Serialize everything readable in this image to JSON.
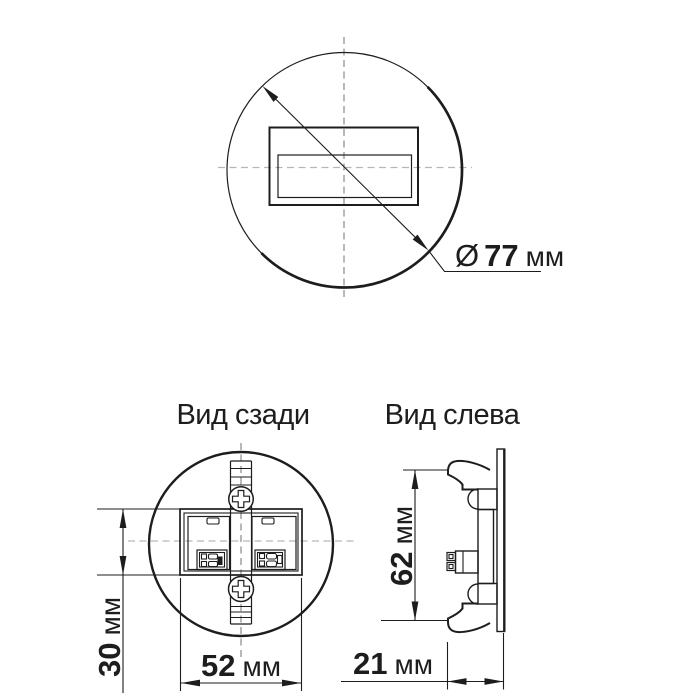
{
  "colors": {
    "line": "#1d1d1d",
    "centerline_dark": "#8a8a8a",
    "centerline_light": "#b6b6b6",
    "text": "#1d1d1d",
    "background": "#ffffff"
  },
  "front_view": {
    "dim_diameter": {
      "symbol": "Ø",
      "value": "77",
      "unit": "мм"
    }
  },
  "back_view": {
    "title": "Вид сзади",
    "dim_height": {
      "value": "30",
      "unit": "мм"
    },
    "dim_width": {
      "value": "52",
      "unit": "мм"
    }
  },
  "left_view": {
    "title": "Вид слева",
    "dim_height": {
      "value": "62",
      "unit": "мм"
    },
    "dim_depth": {
      "value": "21",
      "unit": "мм"
    }
  }
}
